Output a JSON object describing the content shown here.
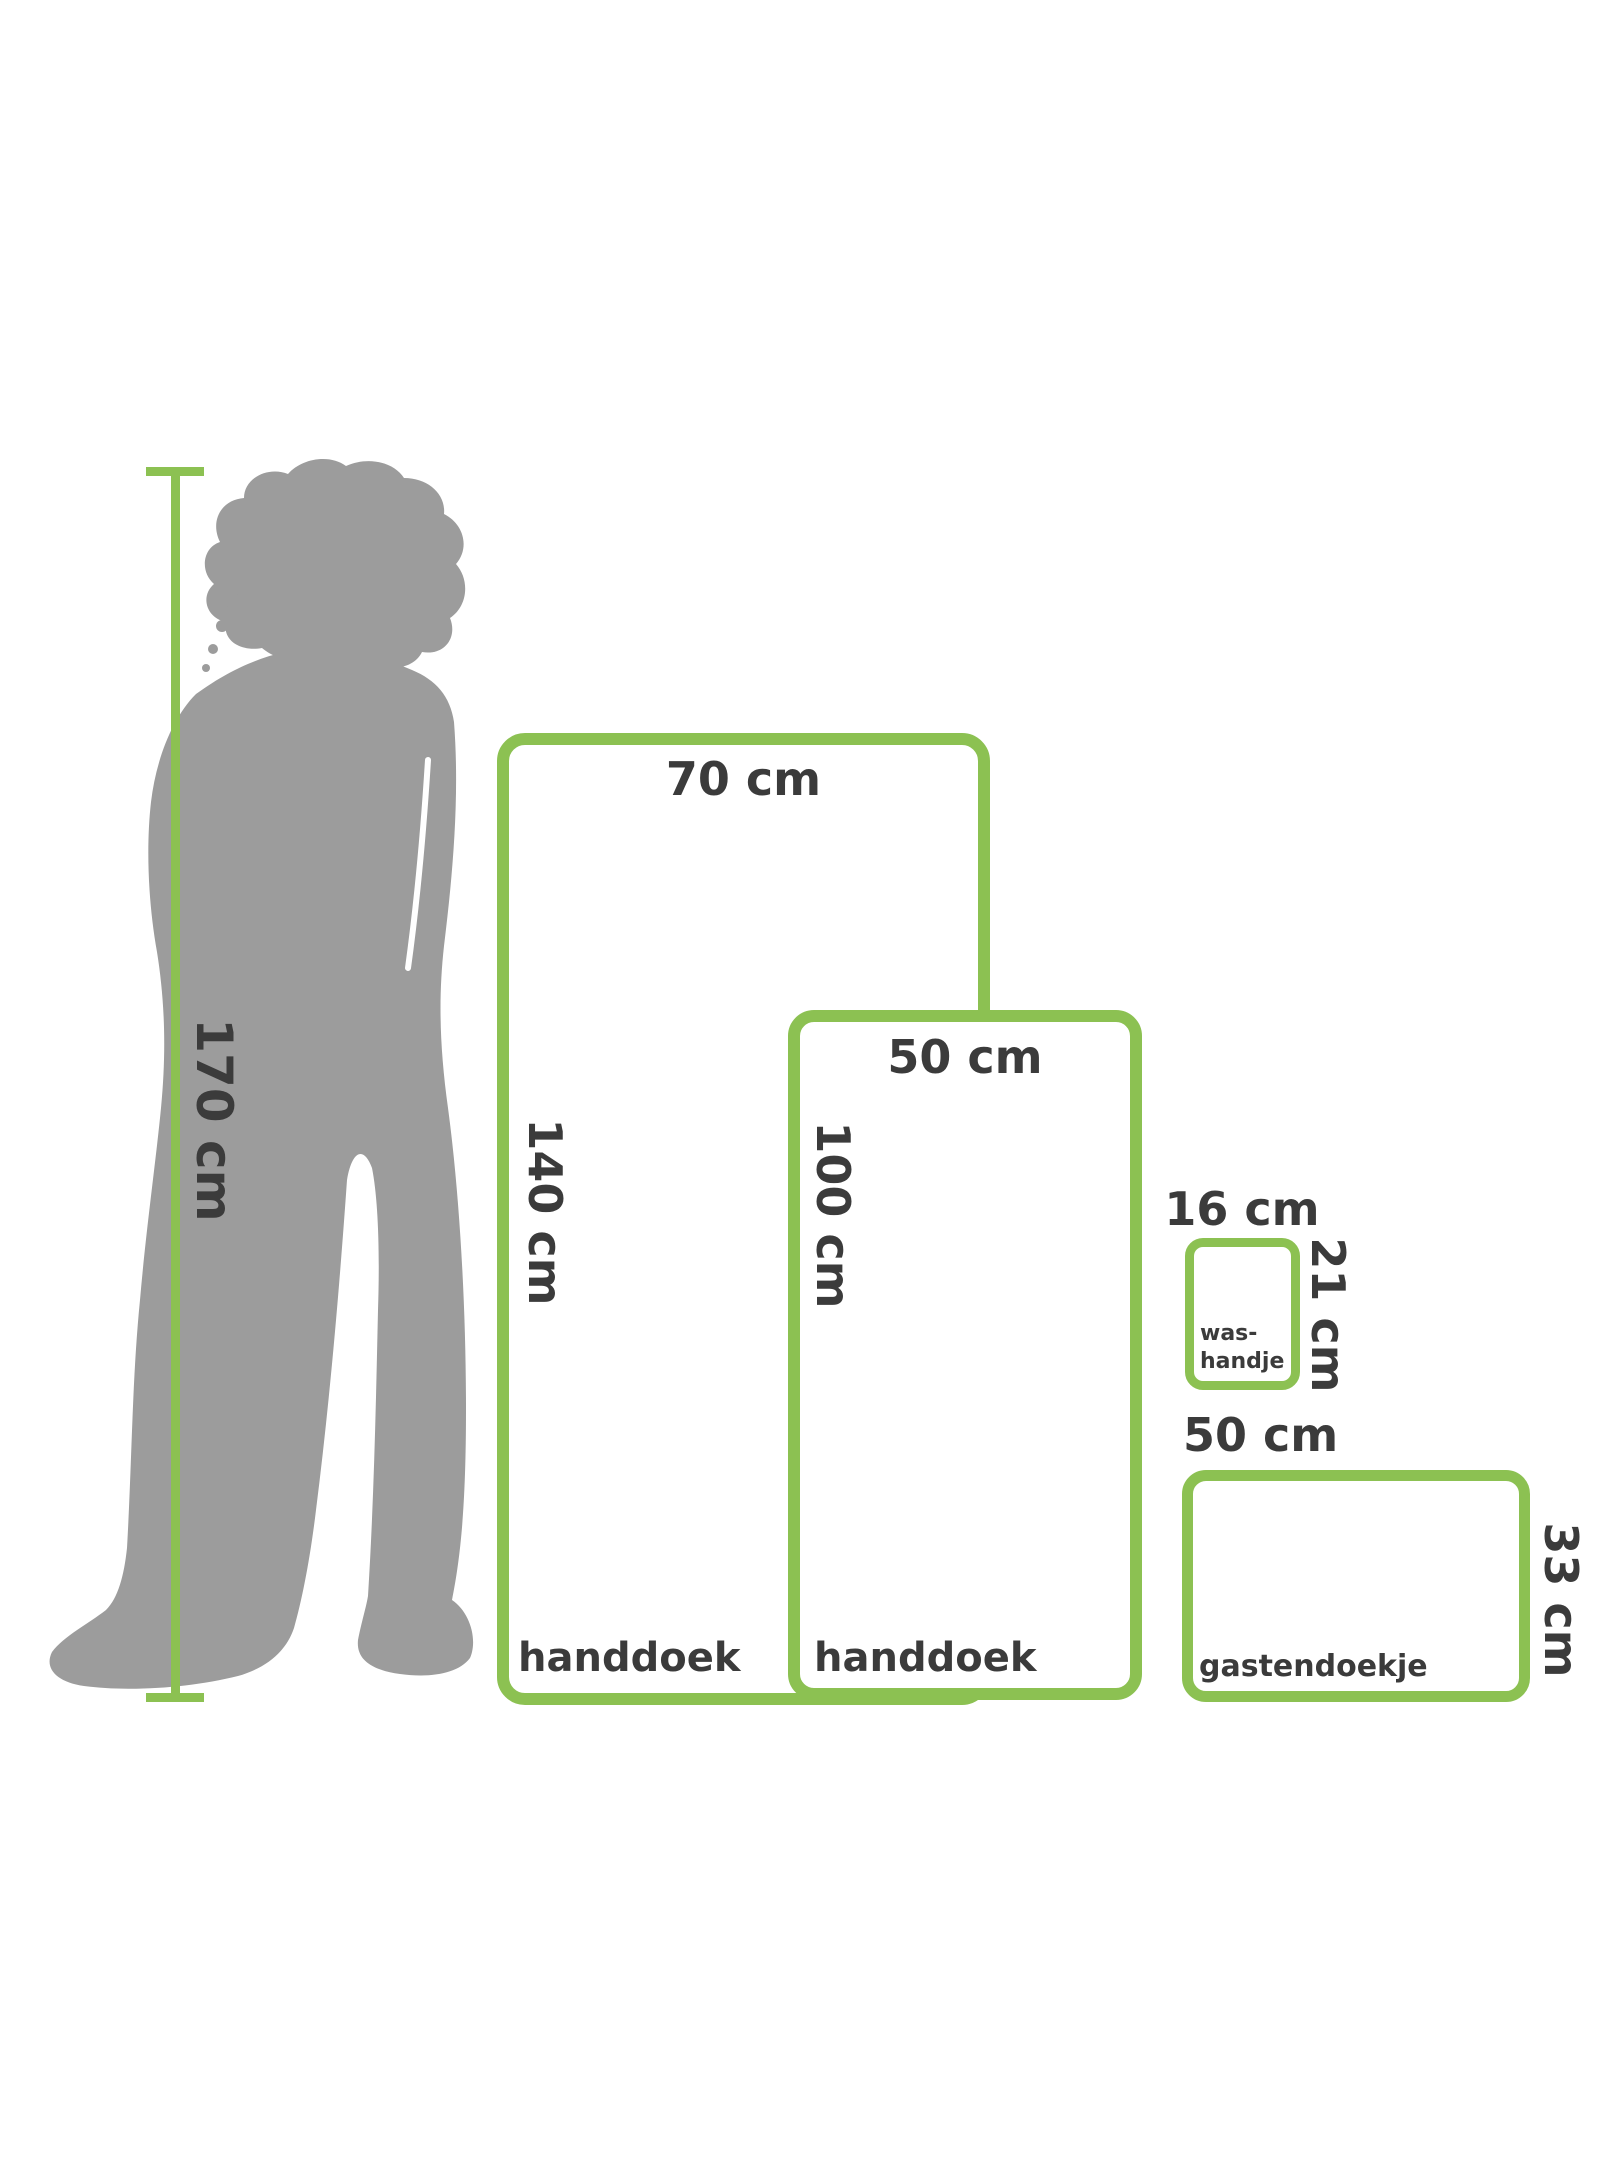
{
  "canvas": {
    "width": 1600,
    "height": 2182,
    "background": "#FFFFFF"
  },
  "colors": {
    "accent_green": "#8CC152",
    "silhouette_gray": "#9C9C9C",
    "text_dark": "#3B3B3B"
  },
  "person": {
    "height_label": "170 cm",
    "icon": "standing-person-silhouette"
  },
  "towels": [
    {
      "id": "handdoek-large",
      "name_label": "handdoek",
      "width_label": "70 cm",
      "height_label": "140 cm"
    },
    {
      "id": "handdoek-medium",
      "name_label": "handdoek",
      "width_label": "50 cm",
      "height_label": "100 cm"
    },
    {
      "id": "washandje",
      "name_line1": "was-",
      "name_line2": "handje",
      "width_label": "16 cm",
      "height_label": "21 cm"
    },
    {
      "id": "gastendoekje",
      "name_label": "gastendoekje",
      "width_label": "50 cm",
      "height_label": "33 cm"
    }
  ]
}
